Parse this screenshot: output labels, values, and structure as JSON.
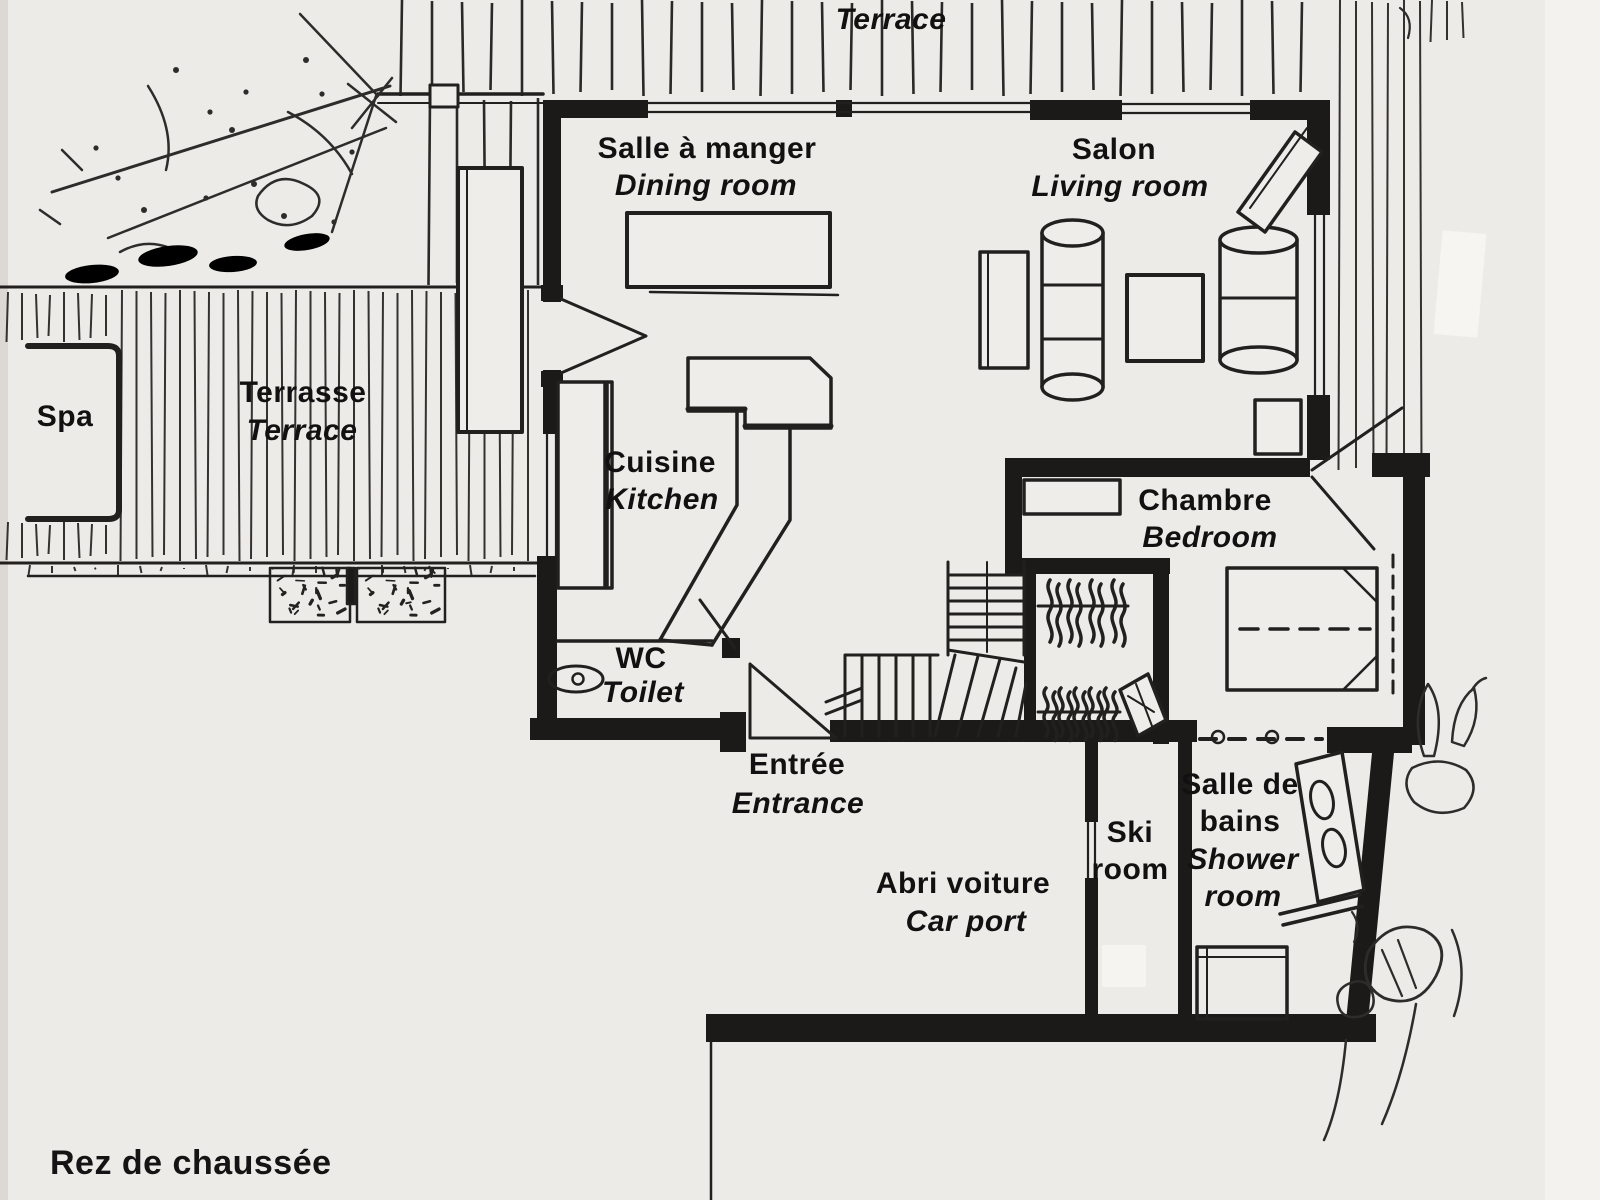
{
  "title": "Rez de chaussée",
  "labels": {
    "terrace_top": {
      "en": "Terrace"
    },
    "dining": {
      "fr": "Salle à manger",
      "en": "Dining room"
    },
    "living": {
      "fr": "Salon",
      "en": "Living room"
    },
    "spa": {
      "fr": "Spa"
    },
    "terrace_left": {
      "fr": "Terrasse",
      "en": "Terrace"
    },
    "kitchen": {
      "fr": "Cuisine",
      "en": "Kitchen"
    },
    "bedroom": {
      "fr": "Chambre",
      "en": "Bedroom"
    },
    "wc": {
      "fr": "WC",
      "en": "Toilet"
    },
    "entrance": {
      "fr": "Entrée",
      "en": "Entrance"
    },
    "carport": {
      "fr": "Abri voiture",
      "en": "Car port"
    },
    "ski_room": {
      "en": "Ski room"
    },
    "shower_room": {
      "fr": "Salle de bains",
      "en": "Shower room"
    }
  },
  "colors": {
    "ink": "#21201e",
    "paper": "#edebe8"
  }
}
